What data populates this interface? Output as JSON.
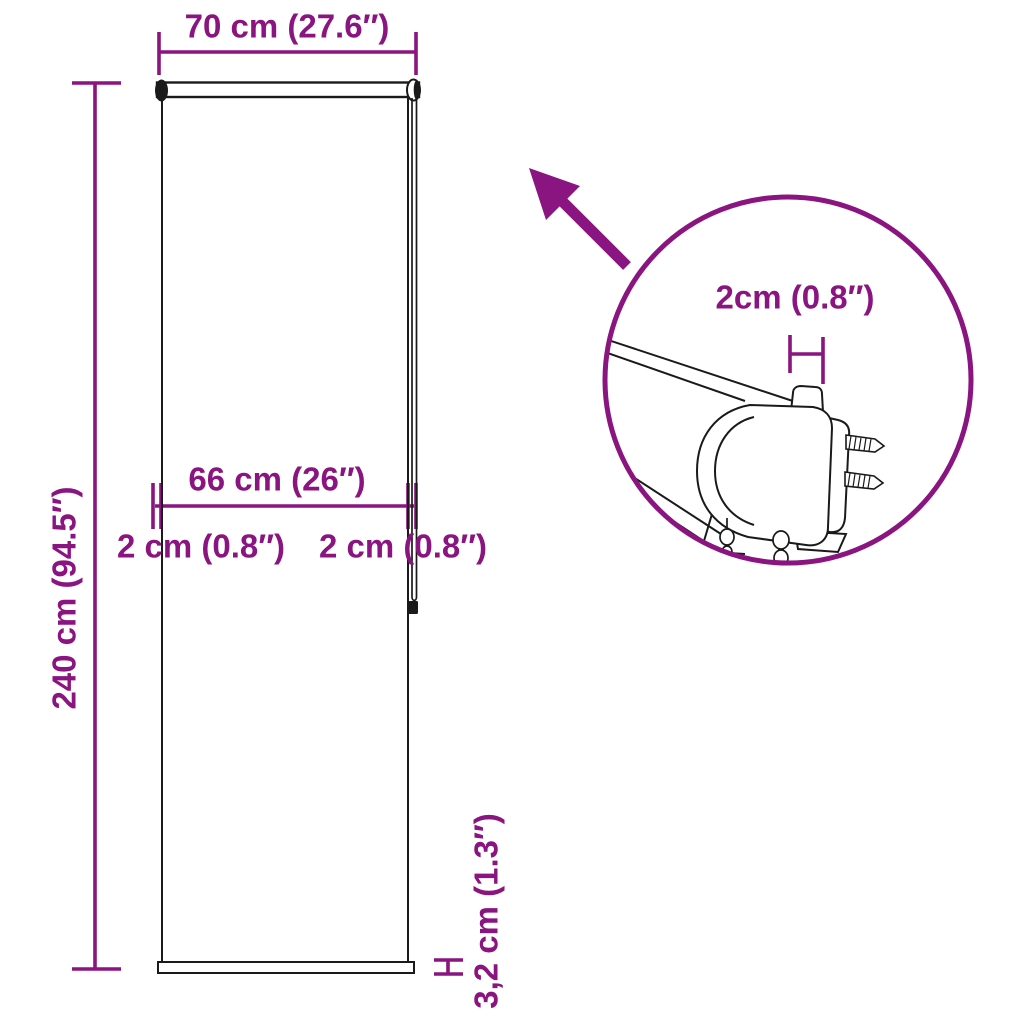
{
  "product_diagram": {
    "subject": "roller blind dimension drawing",
    "dimensions": {
      "total_width": "70 cm (27.6″)",
      "drop_height": "240 cm (94.5″)",
      "fabric_width": "66 cm (26″)",
      "side_offset_left": "2 cm (0.8″)",
      "side_offset_right": "2 cm (0.8″)",
      "bottom_bar_height": "3,2 cm (1.3″)",
      "bracket_tab_width": "2cm (0.8″)"
    },
    "colors": {
      "accent": "#8A1480",
      "line": "#1A1A1A",
      "background": "#FFFFFF"
    }
  }
}
